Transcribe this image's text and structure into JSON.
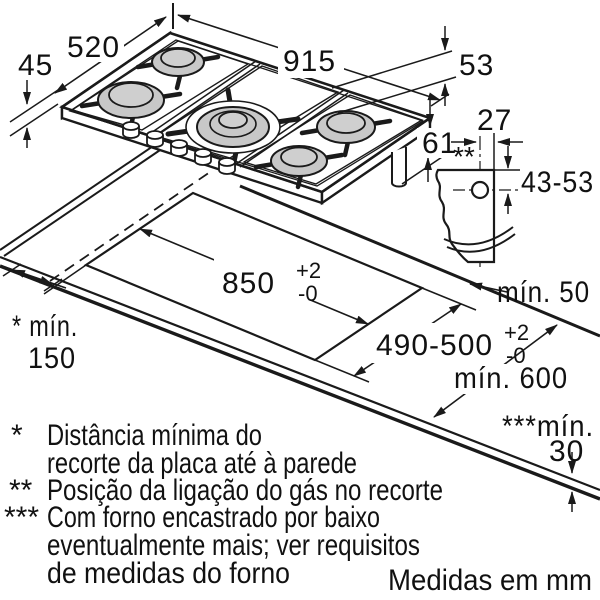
{
  "labels": {
    "d45": "45",
    "d520": "520",
    "d915": "915",
    "d53": "53",
    "d27": "27",
    "d61": "61",
    "d43_53": "43-53",
    "gas_marker": "**",
    "d850": "850",
    "tol_plus": "+2",
    "tol_minus": "-0",
    "d490_500": "490-500",
    "min150_line1": "* mín.",
    "min150_line2": "150",
    "min50": "mín. 50",
    "min600": "mín. 600",
    "min30_line1": "***mín.",
    "min30_line2": "30"
  },
  "footnotes": {
    "f1_marker": "*",
    "f1_line1": "Distância mínima do",
    "f1_line2": "recorte da placa até à parede",
    "f2_marker": "**",
    "f2_line1": "Posição da ligação do gás no recorte",
    "f3_marker": "***",
    "f3_line1": "Com forno encastrado por baixo",
    "f3_line2": "eventualmente mais; ver requisitos",
    "f3_line3": "de medidas do forno"
  },
  "units_note": "Medidas em mm",
  "colors": {
    "line": "#1a1a1a",
    "burner_gray": "#c8c8c8",
    "burner_cap": "#cfcfcf"
  }
}
